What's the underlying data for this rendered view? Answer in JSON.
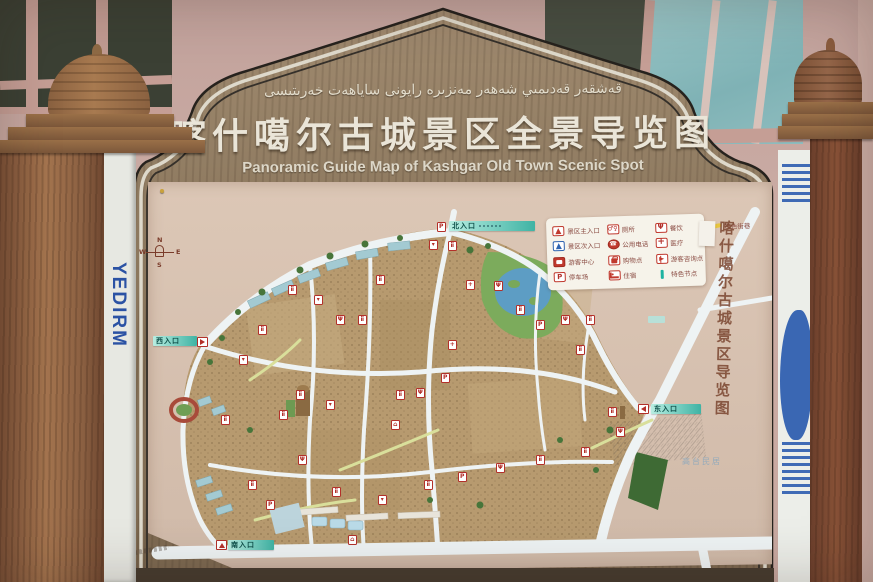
{
  "sign": {
    "title_uyghur": "قەشقەر قەدىمىي شەھەر مەنزىرە رايونى ساياھەت خەرىتىسى",
    "title_cn": "喀什噶尔古城景区全景导览图",
    "title_en": "Panoramic Guide Map of Kashgar Old Town Scenic Spot",
    "side_calligraphy": "喀什噶尔古城景区导览图"
  },
  "map": {
    "compass": {
      "n": "N",
      "s": "S",
      "e": "E",
      "w": "W"
    },
    "legend_items": [
      {
        "icon": "entrance-main",
        "label": "景区主入口"
      },
      {
        "icon": "entrance-sub",
        "label": "景区次入口"
      },
      {
        "icon": "visitor-center",
        "label": "游客中心"
      },
      {
        "icon": "parking",
        "label": "停车场"
      },
      {
        "icon": "toilet",
        "label": "厕所"
      },
      {
        "icon": "phone",
        "label": "公用电话"
      },
      {
        "icon": "shopping",
        "label": "购物点"
      },
      {
        "icon": "lodging",
        "label": "住宿"
      },
      {
        "icon": "dining",
        "label": "餐饮"
      },
      {
        "icon": "medical",
        "label": "医疗"
      },
      {
        "icon": "info-point",
        "label": "游客咨询点"
      },
      {
        "icon": "feature-node",
        "label": "特色节点"
      },
      {
        "icon": "feature-street",
        "label": "特色街巷"
      }
    ],
    "entrances": {
      "north": "北入口",
      "south": "南入口",
      "east": "东入口",
      "west": "西入口"
    },
    "area_label": "高台民居",
    "marker_glyphs": {
      "wc": "ii",
      "p": "P",
      "food": "Ψ",
      "med": "+",
      "shop": "▾",
      "bed": "⌂"
    },
    "markers": [
      {
        "x": 441,
        "y": 227,
        "t": "p"
      },
      {
        "x": 433,
        "y": 245,
        "t": "shop"
      },
      {
        "x": 452,
        "y": 246,
        "t": "wc"
      },
      {
        "x": 292,
        "y": 290,
        "t": "wc"
      },
      {
        "x": 318,
        "y": 300,
        "t": "shop"
      },
      {
        "x": 340,
        "y": 320,
        "t": "food"
      },
      {
        "x": 362,
        "y": 320,
        "t": "wc"
      },
      {
        "x": 262,
        "y": 330,
        "t": "wc"
      },
      {
        "x": 243,
        "y": 360,
        "t": "shop"
      },
      {
        "x": 300,
        "y": 395,
        "t": "wc"
      },
      {
        "x": 283,
        "y": 415,
        "t": "wc"
      },
      {
        "x": 330,
        "y": 405,
        "t": "shop"
      },
      {
        "x": 400,
        "y": 395,
        "t": "wc"
      },
      {
        "x": 420,
        "y": 393,
        "t": "food"
      },
      {
        "x": 445,
        "y": 378,
        "t": "p"
      },
      {
        "x": 470,
        "y": 285,
        "t": "med"
      },
      {
        "x": 498,
        "y": 286,
        "t": "food"
      },
      {
        "x": 520,
        "y": 310,
        "t": "wc"
      },
      {
        "x": 540,
        "y": 325,
        "t": "p"
      },
      {
        "x": 565,
        "y": 320,
        "t": "food"
      },
      {
        "x": 590,
        "y": 320,
        "t": "wc"
      },
      {
        "x": 580,
        "y": 350,
        "t": "wc"
      },
      {
        "x": 612,
        "y": 412,
        "t": "wc"
      },
      {
        "x": 620,
        "y": 432,
        "t": "food"
      },
      {
        "x": 302,
        "y": 460,
        "t": "food"
      },
      {
        "x": 336,
        "y": 492,
        "t": "wc"
      },
      {
        "x": 382,
        "y": 500,
        "t": "shop"
      },
      {
        "x": 428,
        "y": 485,
        "t": "wc"
      },
      {
        "x": 462,
        "y": 477,
        "t": "p"
      },
      {
        "x": 500,
        "y": 468,
        "t": "food"
      },
      {
        "x": 540,
        "y": 460,
        "t": "wc"
      },
      {
        "x": 585,
        "y": 452,
        "t": "wc"
      },
      {
        "x": 252,
        "y": 485,
        "t": "wc"
      },
      {
        "x": 270,
        "y": 505,
        "t": "p"
      },
      {
        "x": 225,
        "y": 420,
        "t": "wc"
      },
      {
        "x": 380,
        "y": 280,
        "t": "wc"
      },
      {
        "x": 452,
        "y": 345,
        "t": "med"
      },
      {
        "x": 352,
        "y": 540,
        "t": "bed"
      },
      {
        "x": 395,
        "y": 425,
        "t": "bed"
      }
    ]
  },
  "surroundings": {
    "left_sign_text": "YEDIRM"
  },
  "colors": {
    "accent_teal": "#2fa99b",
    "marker_red": "#b3302a",
    "board_wood": "#8a7258"
  }
}
